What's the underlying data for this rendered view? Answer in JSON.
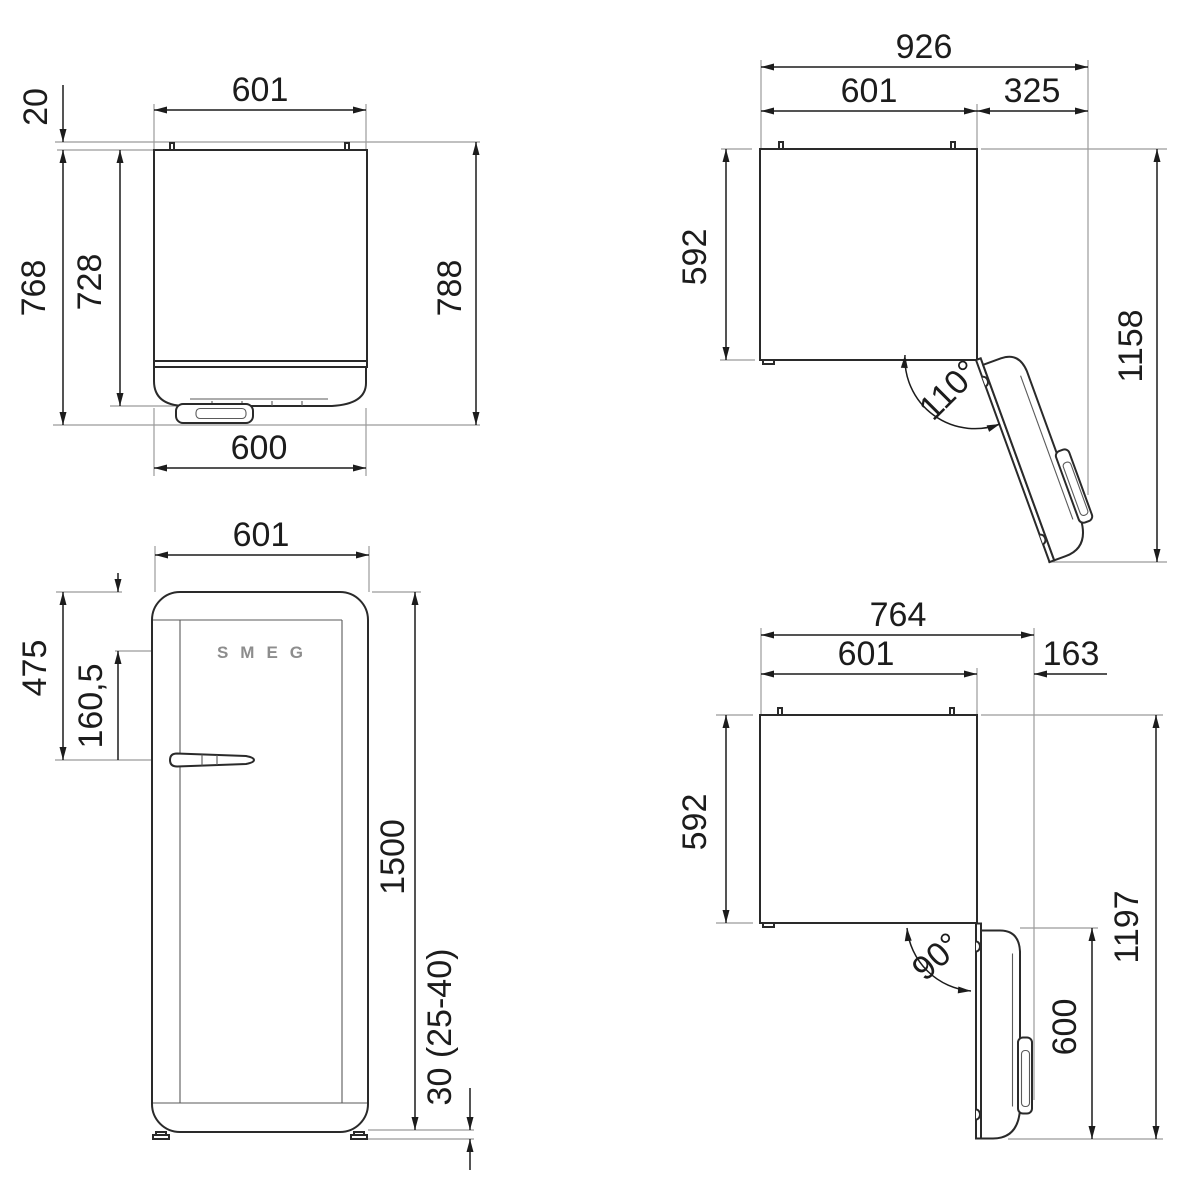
{
  "drawing": {
    "type": "technical-dimension-diagram",
    "subject": "refrigerator",
    "units": "mm",
    "colors": {
      "background": "#ffffff",
      "outline": "#2a2a2a",
      "dimension": "#1c1c1c",
      "extension": "#9b9b9b",
      "logo": "#8d8d8d"
    },
    "views": {
      "top_closed": {
        "name": "top view, door closed",
        "width_top": "601",
        "wall_gap": "20",
        "depth_to_front": "768",
        "body_depth": "728",
        "total_depth": "788",
        "width_bottom": "600"
      },
      "top_open_110": {
        "name": "top view, door open 110°",
        "total_width": "926",
        "body_width": "601",
        "door_side": "325",
        "body_depth": "592",
        "total_depth": "1158",
        "angle": "110°"
      },
      "front": {
        "name": "front view",
        "width": "601",
        "handle_from_top": "475",
        "logo_from_top": "160,5",
        "height": "1500",
        "feet": "30 (25-40)",
        "logo": "SMEG"
      },
      "top_open_90": {
        "name": "top view, door open 90°",
        "total_width": "764",
        "body_width": "601",
        "door_side": "163",
        "body_depth": "592",
        "total_depth": "1197",
        "door_depth": "600",
        "angle": "90°"
      }
    }
  }
}
